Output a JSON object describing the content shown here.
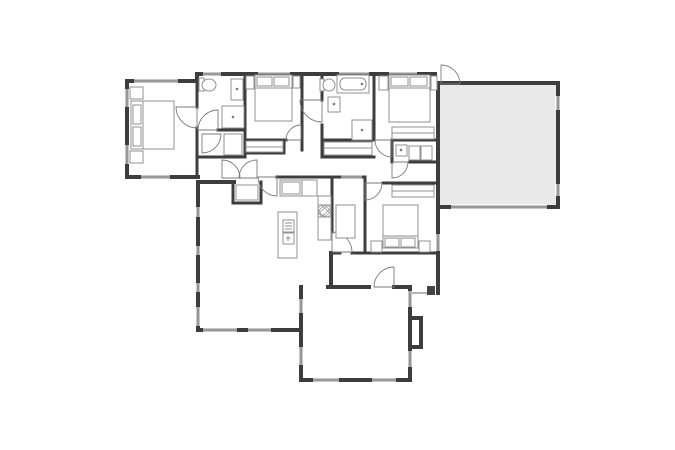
{
  "meta": {
    "title": "House floor plan",
    "canvas": {
      "w": 675,
      "h": 450
    }
  },
  "palette": {
    "background": "#ffffff",
    "wall": "#3d3d3d",
    "window_frame": "#c8c8c8",
    "window_line": "#666666",
    "door": "#7a7a7a",
    "furniture": "#909090",
    "garage_fill": "#e9e9e9",
    "porch_line": "#b5b5b5",
    "post_fill": "#444444"
  },
  "fills": [
    {
      "name": "garage-floor",
      "x": 440,
      "y": 85,
      "w": 116,
      "h": 120
    }
  ],
  "rooms": [
    {
      "name": "room-master-bedroom",
      "x": 129,
      "y": 83,
      "w": 66,
      "h": 92
    },
    {
      "name": "room-master-bath",
      "x": 199,
      "y": 76,
      "w": 44,
      "h": 52
    },
    {
      "name": "room-master-closet",
      "x": 199,
      "y": 132,
      "w": 44,
      "h": 23
    },
    {
      "name": "room-bedroom-2",
      "x": 247,
      "y": 76,
      "w": 53,
      "h": 62
    },
    {
      "name": "room-hall-bath",
      "x": 324,
      "y": 76,
      "w": 48,
      "h": 62
    },
    {
      "name": "room-bedroom-3",
      "x": 376,
      "y": 76,
      "w": 60,
      "h": 62
    },
    {
      "name": "room-laundry",
      "x": 394,
      "y": 142,
      "w": 42,
      "h": 19
    },
    {
      "name": "room-garage",
      "x": 440,
      "y": 85,
      "w": 116,
      "h": 120
    },
    {
      "name": "room-kitchen",
      "x": 262,
      "y": 179,
      "w": 68,
      "h": 78
    },
    {
      "name": "room-dining-nook",
      "x": 334,
      "y": 179,
      "w": 29,
      "h": 72
    },
    {
      "name": "room-bedroom-4",
      "x": 367,
      "y": 185,
      "w": 69,
      "h": 66
    },
    {
      "name": "room-living-room",
      "x": 200,
      "y": 184,
      "w": 99,
      "h": 144
    },
    {
      "name": "room-family-room",
      "x": 303,
      "y": 289,
      "w": 105,
      "h": 89
    },
    {
      "name": "room-hallway",
      "x": 199,
      "y": 157,
      "w": 230,
      "h": 18
    }
  ],
  "walls": {
    "exterior": [
      [
        127,
        81,
        197,
        81
      ],
      [
        127,
        81,
        127,
        177
      ],
      [
        127,
        177,
        198,
        177
      ],
      [
        197,
        74,
        197,
        81
      ],
      [
        197,
        74,
        435,
        74
      ],
      [
        435,
        74,
        435,
        87
      ],
      [
        441,
        83,
        558,
        83
      ],
      [
        558,
        83,
        558,
        207
      ],
      [
        441,
        207,
        558,
        207
      ],
      [
        438,
        83,
        438,
        293
      ],
      [
        198,
        182,
        198,
        330
      ],
      [
        198,
        182,
        234,
        182
      ],
      [
        198,
        330,
        301,
        330
      ],
      [
        301,
        287,
        301,
        380
      ],
      [
        301,
        380,
        410,
        380
      ],
      [
        410,
        287,
        410,
        380
      ],
      [
        328,
        287,
        369,
        287
      ],
      [
        394,
        287,
        410,
        287
      ],
      [
        410,
        318,
        421,
        318
      ],
      [
        421,
        318,
        421,
        347
      ],
      [
        410,
        347,
        421,
        347
      ],
      [
        331,
        253,
        331,
        287
      ]
    ],
    "interior": [
      [
        197,
        81,
        197,
        107
      ],
      [
        197,
        128,
        197,
        177
      ],
      [
        218,
        130,
        245,
        130
      ],
      [
        245,
        74,
        245,
        157
      ],
      [
        197,
        157,
        245,
        157
      ],
      [
        245,
        140,
        286,
        140
      ],
      [
        284,
        140,
        284,
        153
      ],
      [
        245,
        153,
        284,
        153
      ],
      [
        302,
        74,
        302,
        150
      ],
      [
        322,
        74,
        322,
        100
      ],
      [
        322,
        125,
        322,
        157
      ],
      [
        374,
        74,
        374,
        140
      ],
      [
        322,
        140,
        374,
        140
      ],
      [
        322,
        157,
        374,
        157
      ],
      [
        392,
        140,
        438,
        140
      ],
      [
        392,
        142,
        392,
        162
      ],
      [
        410,
        162,
        438,
        162
      ],
      [
        277,
        177,
        332,
        177
      ],
      [
        233,
        182,
        233,
        203
      ],
      [
        233,
        203,
        261,
        203
      ],
      [
        261,
        182,
        261,
        203
      ],
      [
        332,
        177,
        365,
        177
      ],
      [
        365,
        177,
        365,
        253
      ],
      [
        383,
        183,
        438,
        183
      ],
      [
        332,
        177,
        332,
        232
      ],
      [
        332,
        253,
        340,
        253
      ],
      [
        352,
        253,
        438,
        253
      ]
    ]
  },
  "windows": [
    [
      134,
      81,
      178,
      81
    ],
    [
      127,
      89,
      127,
      107
    ],
    [
      127,
      145,
      127,
      164
    ],
    [
      141,
      177,
      170,
      177
    ],
    [
      203,
      74,
      221,
      74
    ],
    [
      258,
      74,
      290,
      74
    ],
    [
      339,
      74,
      369,
      74
    ],
    [
      389,
      74,
      417,
      74
    ],
    [
      198,
      207,
      198,
      217
    ],
    [
      198,
      246,
      198,
      255
    ],
    [
      198,
      283,
      198,
      292
    ],
    [
      198,
      307,
      198,
      326
    ],
    [
      203,
      330,
      237,
      330
    ],
    [
      248,
      330,
      271,
      330
    ],
    [
      301,
      299,
      301,
      313
    ],
    [
      301,
      347,
      301,
      365
    ],
    [
      313,
      380,
      339,
      380
    ],
    [
      372,
      380,
      396,
      380
    ],
    [
      410,
      291,
      410,
      307
    ],
    [
      410,
      351,
      410,
      367
    ],
    [
      438,
      234,
      438,
      251
    ],
    [
      341,
      177,
      362,
      177
    ],
    [
      558,
      96,
      558,
      110
    ],
    [
      558,
      184,
      558,
      196
    ],
    [
      451,
      207,
      547,
      207
    ]
  ],
  "doors": [
    {
      "name": "master-bedroom-door",
      "hinge": [
        197,
        107
      ],
      "r": 21,
      "a1": 90,
      "a2": 180
    },
    {
      "name": "master-bath-door",
      "hinge": [
        218,
        130
      ],
      "r": 20,
      "a1": 180,
      "a2": 270
    },
    {
      "name": "master-closet-door",
      "hinge": [
        202,
        134
      ],
      "r": 19,
      "a1": 0,
      "a2": 90
    },
    {
      "name": "hall-door-left",
      "hinge": [
        222,
        178
      ],
      "r": 18,
      "a1": 270,
      "a2": 360
    },
    {
      "name": "hall-door-right",
      "hinge": [
        257,
        178
      ],
      "r": 18,
      "a1": 180,
      "a2": 270
    },
    {
      "name": "bedroom2-door",
      "hinge": [
        301,
        140
      ],
      "r": 15,
      "a1": 180,
      "a2": 270
    },
    {
      "name": "hall-bath-door",
      "hinge": [
        322,
        100
      ],
      "r": 22,
      "a1": 90,
      "a2": 180
    },
    {
      "name": "bedroom3-door",
      "hinge": [
        392,
        140
      ],
      "r": 17,
      "a1": 90,
      "a2": 180
    },
    {
      "name": "laundry-door",
      "hinge": [
        392,
        162
      ],
      "r": 16,
      "a1": 0,
      "a2": 90
    },
    {
      "name": "garage-entry-door",
      "hinge": [
        441,
        84
      ],
      "r": 19,
      "a1": 270,
      "a2": 360
    },
    {
      "name": "living-room-door",
      "hinge": [
        277,
        177
      ],
      "r": 19,
      "a1": 90,
      "a2": 180
    },
    {
      "name": "dining-nook-door",
      "hinge": [
        332,
        252
      ],
      "r": 20,
      "a1": 270,
      "a2": 360
    },
    {
      "name": "bedroom4-door",
      "hinge": [
        365,
        183
      ],
      "r": 17,
      "a1": 0,
      "a2": 90
    },
    {
      "name": "back-door",
      "hinge": [
        394,
        287
      ],
      "r": 20,
      "a1": 180,
      "a2": 270
    }
  ],
  "furniture": [
    {
      "name": "master-bed",
      "prims": [
        [
          "r",
          131,
          101,
          43,
          48
        ],
        [
          "l",
          143,
          101,
          143,
          149
        ],
        [
          "r",
          133,
          105,
          8,
          19
        ],
        [
          "r",
          133,
          127,
          8,
          19
        ]
      ]
    },
    {
      "name": "master-nightstands",
      "prims": [
        [
          "r",
          130,
          87,
          13,
          12
        ],
        [
          "r",
          130,
          151,
          13,
          12
        ]
      ]
    },
    {
      "name": "master-bath-toilet",
      "prims": [
        [
          "r",
          199,
          78,
          5,
          13
        ],
        [
          "o",
          209,
          85,
          7,
          6
        ]
      ]
    },
    {
      "name": "master-bath-sink",
      "prims": [
        [
          "r",
          231,
          79,
          12,
          21
        ],
        [
          "d",
          237,
          89
        ]
      ]
    },
    {
      "name": "master-shower",
      "prims": [
        [
          "r",
          222,
          106,
          22,
          22
        ],
        [
          "d",
          233,
          117
        ]
      ]
    },
    {
      "name": "master-closet-shelf",
      "prims": [
        [
          "r",
          224,
          134,
          18,
          21
        ]
      ]
    },
    {
      "name": "bedroom2-bed",
      "prims": [
        [
          "r",
          255,
          75,
          37,
          46
        ],
        [
          "l",
          255,
          88,
          292,
          88
        ],
        [
          "r",
          257,
          77,
          15,
          9
        ],
        [
          "r",
          274,
          77,
          15,
          9
        ],
        [
          "r",
          246,
          76,
          8,
          13
        ],
        [
          "r",
          293,
          76,
          7,
          12
        ]
      ]
    },
    {
      "name": "bedroom2-closet-shelf",
      "prims": [
        [
          "r",
          246,
          141,
          37,
          11
        ],
        [
          "l",
          246,
          147,
          283,
          147
        ]
      ]
    },
    {
      "name": "hall-bath-toilet",
      "prims": [
        [
          "r",
          320,
          79,
          4,
          12
        ],
        [
          "o",
          329,
          85,
          6,
          6
        ]
      ]
    },
    {
      "name": "hall-bath-tub",
      "prims": [
        [
          "r",
          337,
          75,
          32,
          18
        ],
        [
          "rr",
          340,
          78,
          26,
          12
        ],
        [
          "d",
          362,
          84
        ]
      ]
    },
    {
      "name": "hall-bath-sink",
      "prims": [
        [
          "r",
          328,
          97,
          12,
          15
        ],
        [
          "d",
          334,
          104
        ]
      ]
    },
    {
      "name": "hall-bath-shower",
      "prims": [
        [
          "r",
          352,
          120,
          20,
          20
        ],
        [
          "d",
          362,
          130
        ]
      ]
    },
    {
      "name": "hall-closet-shelf",
      "prims": [
        [
          "r",
          324,
          142,
          48,
          13
        ],
        [
          "l",
          324,
          148,
          372,
          148
        ]
      ]
    },
    {
      "name": "bedroom3-bed",
      "prims": [
        [
          "r",
          389,
          75,
          41,
          47
        ],
        [
          "l",
          389,
          88,
          430,
          88
        ],
        [
          "r",
          391,
          77,
          17,
          9
        ],
        [
          "r",
          410,
          77,
          17,
          9
        ],
        [
          "r",
          379,
          76,
          9,
          14
        ],
        [
          "r",
          431,
          76,
          6,
          14
        ]
      ]
    },
    {
      "name": "bedroom3-closet-shelf",
      "prims": [
        [
          "r",
          392,
          127,
          42,
          12
        ],
        [
          "l",
          392,
          133,
          434,
          133
        ]
      ]
    },
    {
      "name": "laundry-fixtures",
      "prims": [
        [
          "r",
          396,
          145,
          11,
          11
        ],
        [
          "d",
          401,
          150
        ],
        [
          "r",
          409,
          146,
          11,
          14
        ],
        [
          "r",
          421,
          146,
          11,
          14
        ]
      ]
    },
    {
      "name": "kitchen-counter",
      "prims": [
        [
          "r",
          280,
          180,
          22,
          16
        ],
        [
          "r",
          282,
          182,
          18,
          12
        ],
        [
          "r",
          302,
          180,
          15,
          16
        ]
      ]
    },
    {
      "name": "kitchen-pantry",
      "prims": [
        [
          "r",
          318,
          196,
          13,
          44
        ],
        [
          "hatch",
          318,
          205,
          13,
          12
        ]
      ]
    },
    {
      "name": "kitchen-island",
      "prims": [
        [
          "r",
          278,
          212,
          19,
          46
        ],
        [
          "r",
          283,
          220,
          11,
          12
        ],
        [
          "l",
          285,
          223,
          292,
          223
        ],
        [
          "l",
          285,
          226,
          292,
          226
        ],
        [
          "l",
          285,
          229,
          292,
          229
        ],
        [
          "r",
          283,
          233,
          11,
          11
        ],
        [
          "l",
          286,
          238,
          291,
          238
        ],
        [
          "l",
          288,
          236,
          288,
          241
        ]
      ]
    },
    {
      "name": "dining-table",
      "prims": [
        [
          "r",
          336,
          205,
          19,
          33
        ]
      ]
    },
    {
      "name": "bedroom4-bed",
      "prims": [
        [
          "r",
          383,
          205,
          35,
          43
        ],
        [
          "l",
          383,
          236,
          418,
          236
        ],
        [
          "r",
          385,
          238,
          14,
          9
        ],
        [
          "r",
          401,
          238,
          14,
          9
        ],
        [
          "r",
          371,
          241,
          11,
          11
        ],
        [
          "r",
          419,
          241,
          11,
          11
        ]
      ]
    },
    {
      "name": "bedroom4-closet-shelf",
      "prims": [
        [
          "r",
          392,
          185,
          42,
          12
        ],
        [
          "l",
          392,
          191,
          434,
          191
        ]
      ]
    },
    {
      "name": "mudroom-closet-shelf",
      "prims": [
        [
          "r",
          236,
          185,
          22,
          15
        ]
      ]
    },
    {
      "name": "rear-porch-edge",
      "prims": [
        [
          "lg",
          410,
          293,
          429,
          293
        ],
        [
          "rf",
          427,
          286,
          8,
          9
        ]
      ]
    }
  ]
}
